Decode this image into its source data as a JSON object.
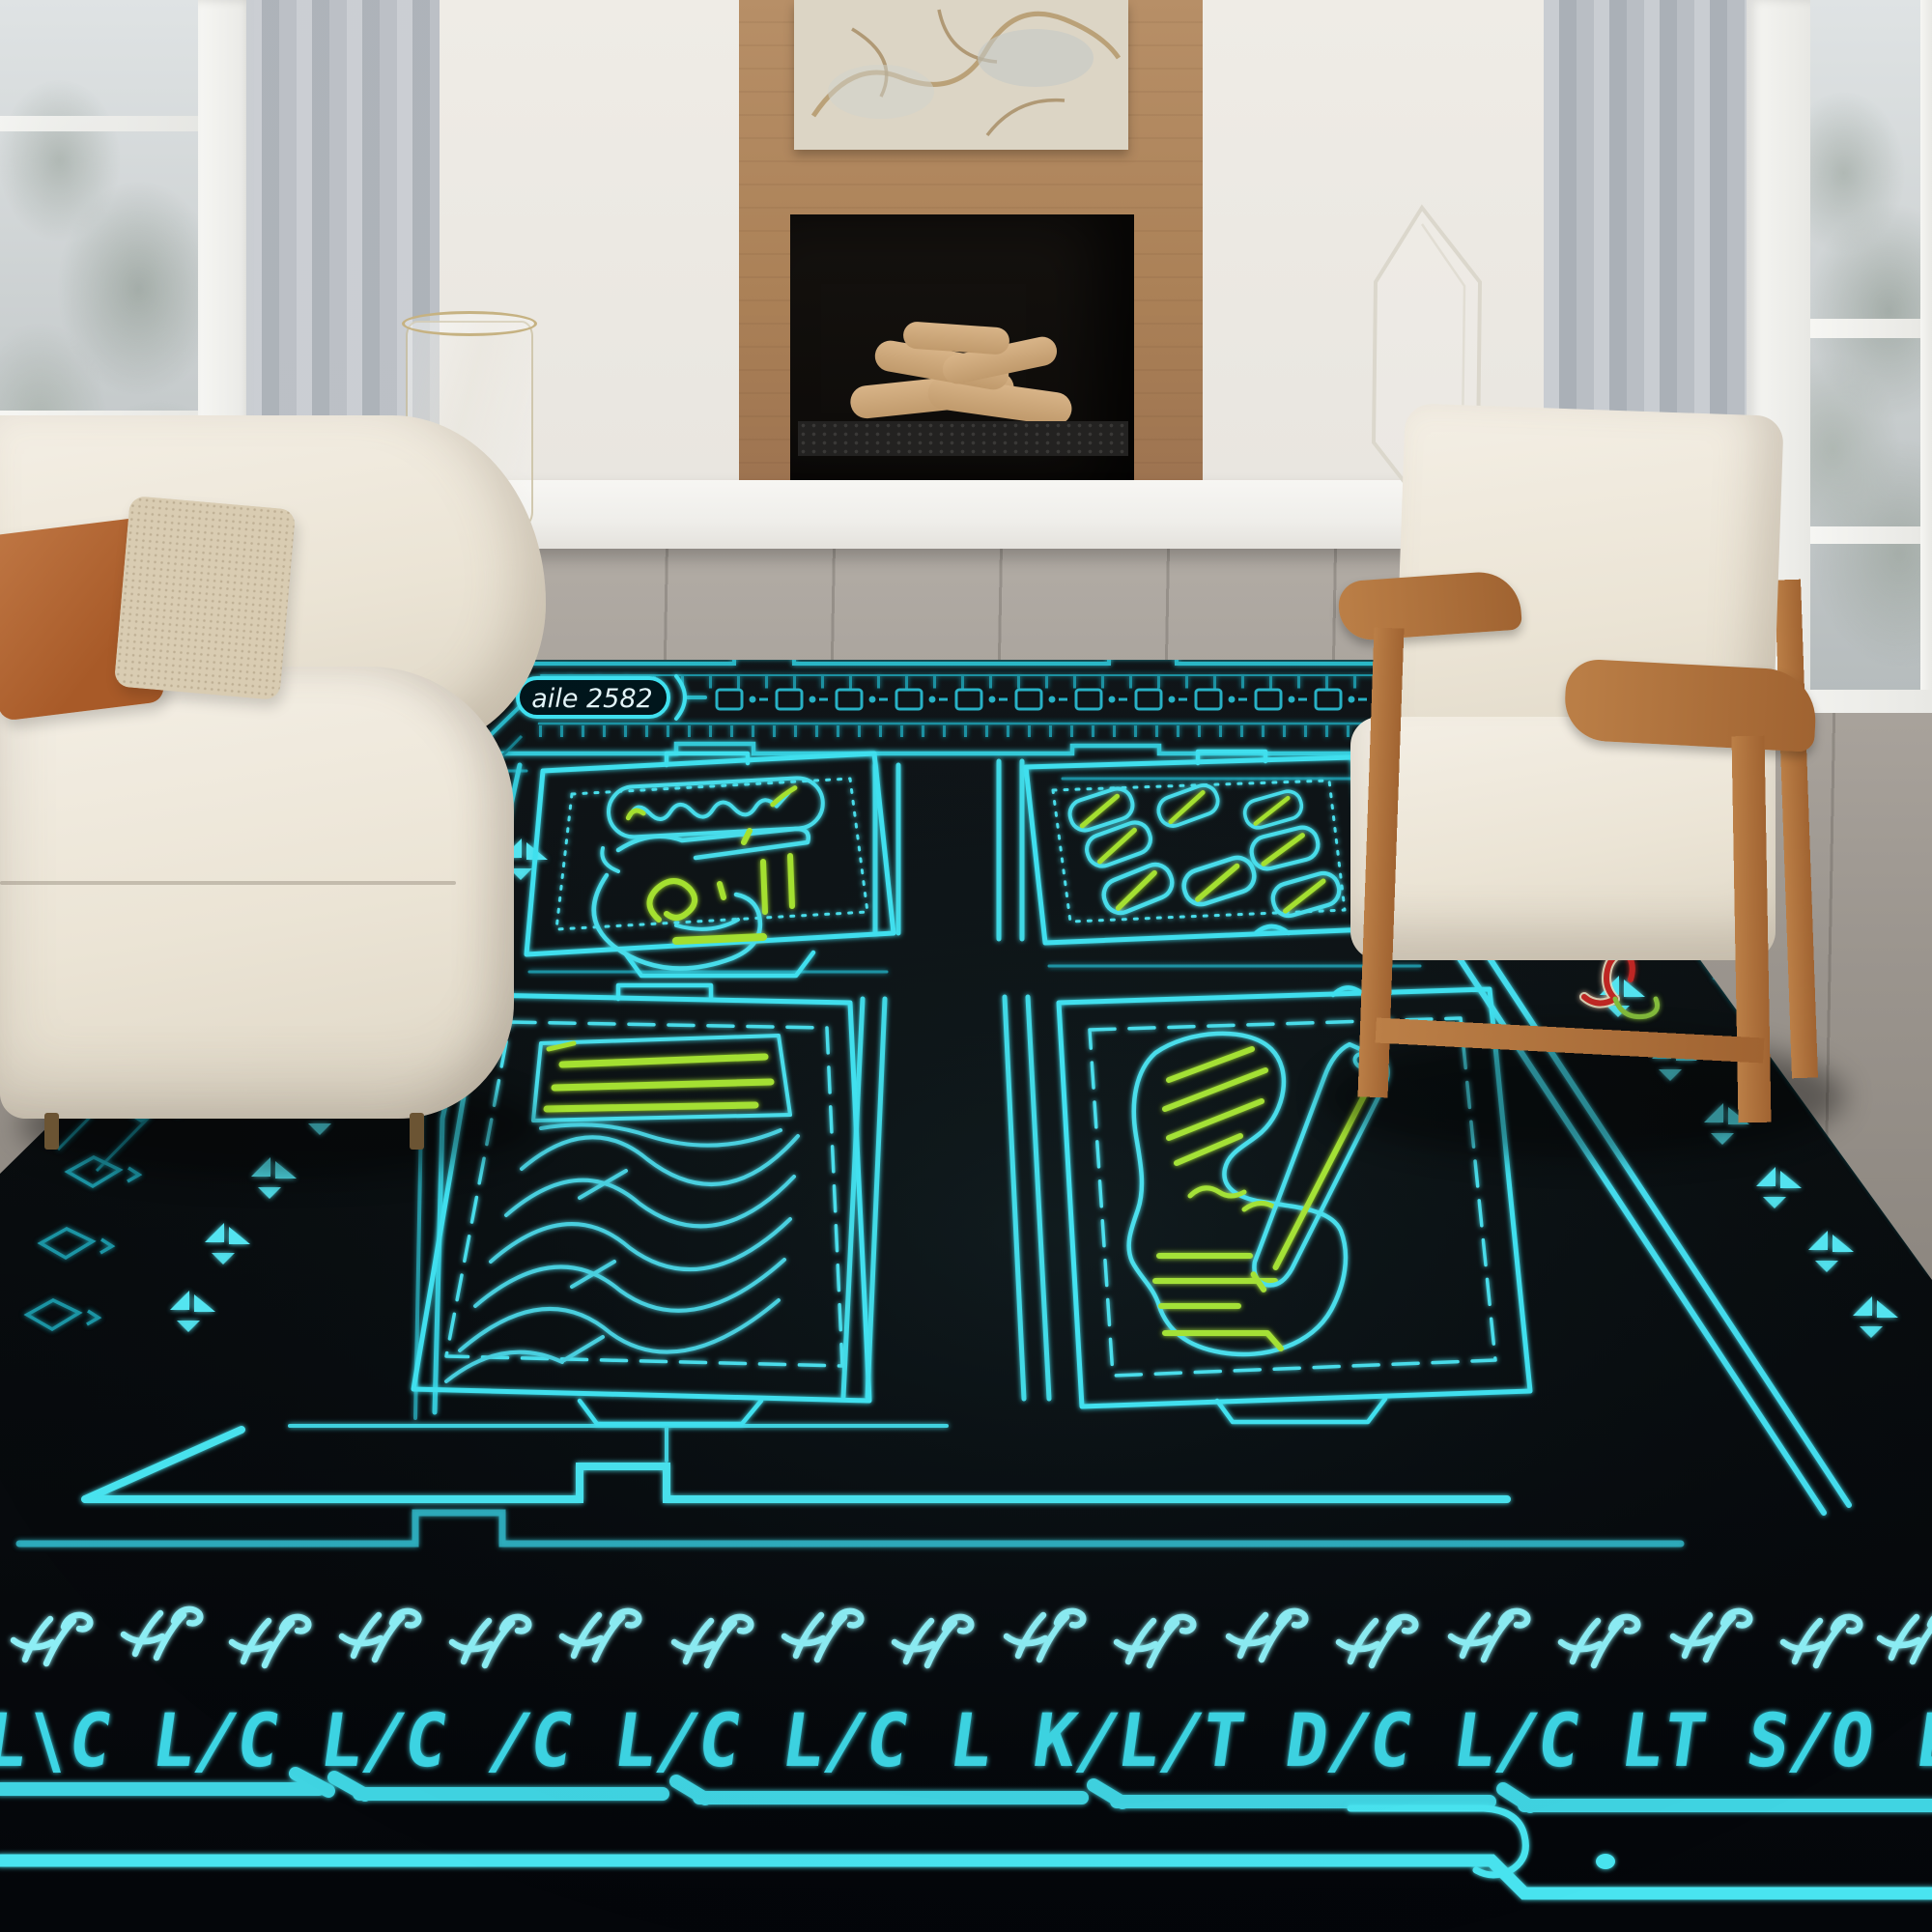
{
  "rug": {
    "label_text": "aile 2582",
    "glyph_row_text": "L\\C L/C L/C /C L/C L/C L K/L/T D/C L/C LT S/O LT",
    "palette": {
      "neon_cyan": "#3fe3f2",
      "neon_cyan_dim": "#1d93a4",
      "neon_cyan_bright": "#55eef8",
      "lime": "#a8e42e",
      "label_white": "#e6f7fb",
      "accent_red": "#c32722",
      "accent_yellow": "#d9c94e",
      "accent_green": "#86bf3a",
      "rug_black": "#07090b"
    }
  },
  "room": {
    "palette": {
      "wall": "#e9e6e0",
      "fireplace_wood": "#ae835b",
      "floor": "#968f88",
      "bench": "#f3f2ee",
      "sofa": "#efe9dc",
      "pillow_rust": "#b4662e",
      "pillow_beige": "#d9ccb2",
      "chair_wood": "#b0763e",
      "curtain": "#b6bac1"
    }
  }
}
